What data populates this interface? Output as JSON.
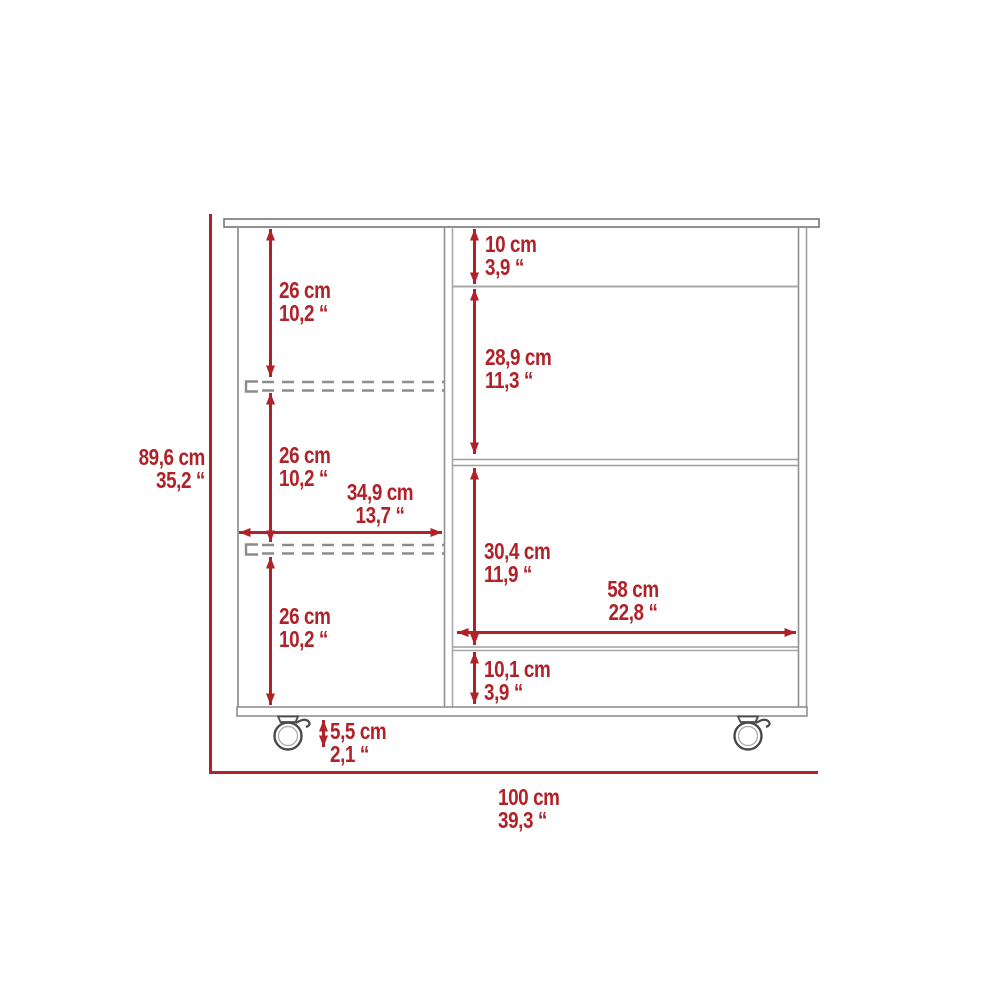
{
  "diagram": {
    "name": "kitchen-cart-dimension-diagram",
    "colors": {
      "dimension_red": "#b12228",
      "furniture_gray": "#9e9e9e",
      "outline_dark": "#757575"
    },
    "overall": {
      "height": {
        "cm": "89,6 cm",
        "in": "35,2 “"
      },
      "width": {
        "cm": "100 cm",
        "in": "39,3 “"
      }
    },
    "left_column": {
      "top_section": {
        "cm": "26 cm",
        "in": "10,2 “"
      },
      "middle_section": {
        "cm": "26 cm",
        "in": "10,2 “"
      },
      "bottom_section": {
        "cm": "26 cm",
        "in": "10,2 “"
      },
      "width": {
        "cm": "34,9 cm",
        "in": "13,7 “"
      }
    },
    "right_column": {
      "top_section": {
        "cm": "10 cm",
        "in": "3,9 “"
      },
      "upper_section": {
        "cm": "28,9 cm",
        "in": "11,3 “"
      },
      "lower_section": {
        "cm": "30,4 cm",
        "in": "11,9 “"
      },
      "width": {
        "cm": "58 cm",
        "in": "22,8 “"
      },
      "bottom_section": {
        "cm": "10,1 cm",
        "in": "3,9 “"
      }
    },
    "caster": {
      "height": {
        "cm": "5,5 cm",
        "in": "2,1 “"
      }
    }
  }
}
